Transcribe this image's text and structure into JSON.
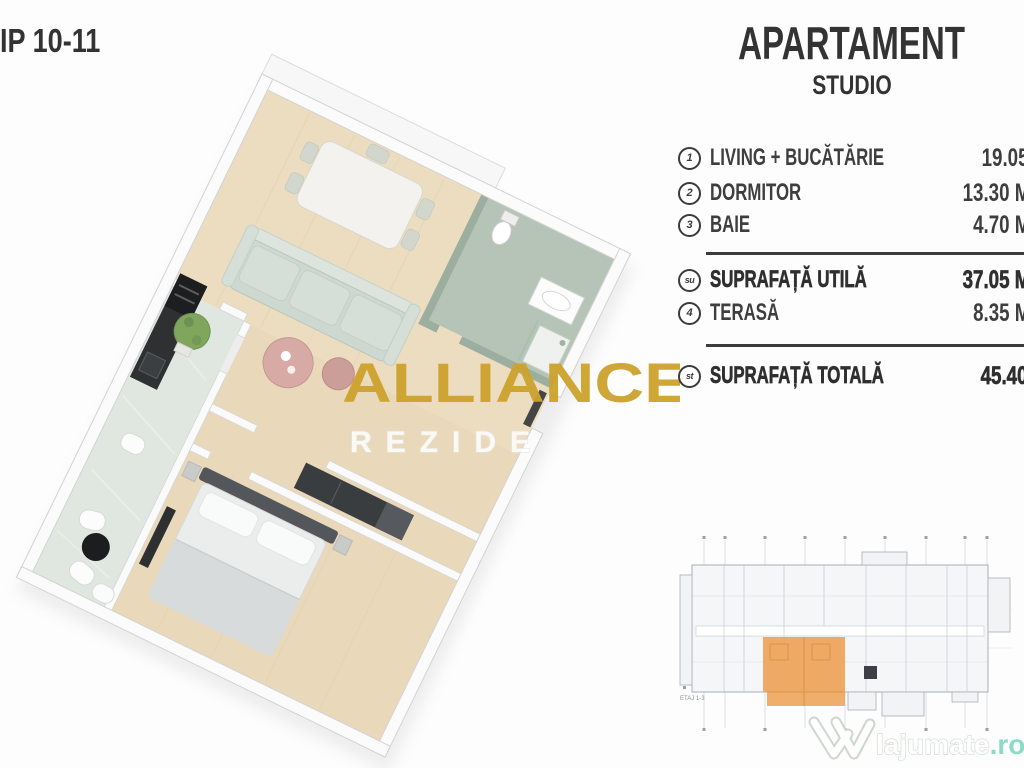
{
  "header": {
    "type_label": "IP 10-11"
  },
  "panel": {
    "title": "APARTAMENT",
    "subtitle": "STUDIO",
    "rooms": [
      {
        "num": "1",
        "label": "LIVING + BUCĂTĂRIE",
        "area": "19.05 M"
      },
      {
        "num": "2",
        "label": "DORMITOR",
        "area": "13.30 M"
      },
      {
        "num": "3",
        "label": "BAIE",
        "area": "4.70 M"
      }
    ],
    "useful": {
      "num": "su",
      "label": "SUPRAFAȚĂ UTILĂ",
      "area": "37.05 M"
    },
    "terrace": {
      "num": "4",
      "label": "TERASĂ",
      "area": "8.35 M"
    },
    "total": {
      "num": "st",
      "label": "SUPRAFAȚĂ TOTALĂ",
      "area": "45.40 M"
    }
  },
  "watermark": {
    "line1": "ALLIANCE",
    "line2": "REZIDE"
  },
  "mini_plan": {
    "floor_label": "ETAJ 1-3"
  },
  "brand_logo": {
    "name": "lajumate",
    "tld": ".ro"
  },
  "colors": {
    "ink": "#3a3a3a",
    "accent_orange": "#eda55c",
    "accent_orange_line": "#d58f3b",
    "watermark_gold": "#cda32d",
    "logo_teal": "#8adcc4"
  }
}
